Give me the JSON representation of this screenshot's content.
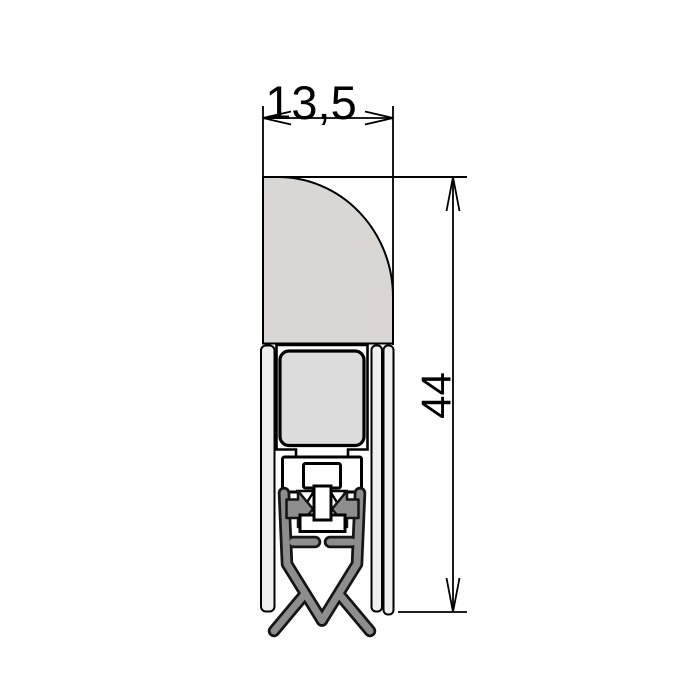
{
  "drawing": {
    "dimensions": {
      "width_label": "13,5",
      "height_label": "44"
    },
    "colors": {
      "background": "#ffffff",
      "line": "#000000",
      "sweep_fill": "#d9d6d4",
      "insert_fill": "#dcdcdc",
      "rail_fill": "#efefef",
      "carrier_fill": "#ffffff",
      "rubber_fill": "#8d8d8d",
      "rubber_outline": "#151515"
    }
  }
}
